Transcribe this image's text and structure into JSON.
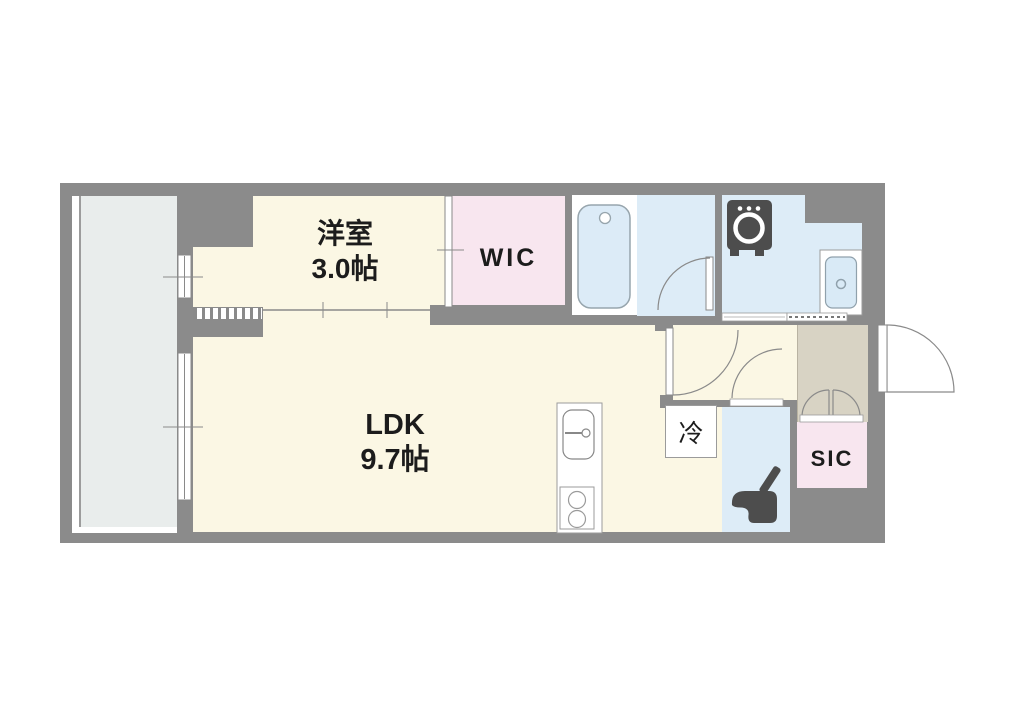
{
  "floorplan": {
    "western_room": {
      "name": "洋室",
      "size": "3.0帖"
    },
    "ldk": {
      "name": "LDK",
      "size": "9.7帖"
    },
    "wic_label": "WIC",
    "sic_label": "SIC",
    "fridge_label": "冷",
    "fixtures": {
      "bathtub": "bathtub-icon",
      "washing_machine": "washing-machine-icon",
      "washbasin": "washbasin-icon",
      "kitchen_sink": "kitchen-sink-icon",
      "gas_stove": "stove-icon",
      "toilet": "toilet-icon"
    },
    "colors": {
      "wall": "#8B8B8B",
      "room_floor": "#FBF7E4",
      "closet_pink": "#F8E6EF",
      "wet_area_blue": "#DDECF7",
      "balcony": "#E9EDEC",
      "entrance": "#D8D3C4",
      "fixture_dark": "#4D4D4D"
    }
  }
}
